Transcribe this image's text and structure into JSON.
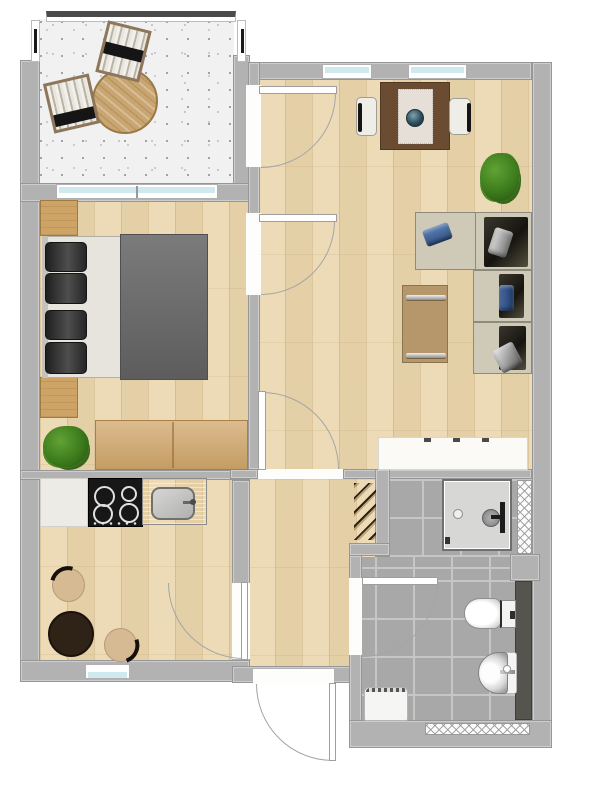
{
  "meta": {
    "kind": "apartment-floor-plan",
    "view": "top-down 2D render"
  },
  "colors": {
    "wall": "#b3b2b2",
    "wall_line": "#969696",
    "wood_floor": "#ecdbb6",
    "balcony_floor": "#f2f1f1",
    "tile": "#a8a8a8",
    "tile_grout": "#c6c6c6",
    "window_glass": "#cfe9ef",
    "railing_dark": "#4b4b4b",
    "door_arc": "#a5a5a5",
    "sofa_beige": "#cfc9b8",
    "sofa_shadow": "#1d1b15",
    "pillow_blue": "#40619c",
    "pillow_gray": "#9b9b99",
    "bed_blanket": "#6c6c6c",
    "bed_sheet": "#e7e4de",
    "bed_pillow": "#303030",
    "wood_furniture": "#cda466",
    "dining_table_brown": "#6a4c33",
    "kitchen_table_brown": "#2f2318",
    "chair_beige": "#d5ba93",
    "plant_green": "#3f7a1e",
    "white_furniture": "#fbfaf6",
    "steel": "#b9b8b6",
    "cooktop_black": "#171717",
    "dark_counter": "#56544e",
    "shower_tray": "#d7d7d6"
  },
  "rooms": [
    {
      "id": "balcony",
      "furniture": [
        "round-wood-table",
        "lounge-chair",
        "lounge-chair"
      ]
    },
    {
      "id": "living-room",
      "furniture": [
        "dining-table",
        "table-runner",
        "decor-bowl",
        "dining-chair",
        "dining-chair",
        "potted-plant",
        "corner-sofa",
        "pillow-blue",
        "pillow-gray",
        "pillow-blue",
        "pillow-gray",
        "coffee-table",
        "sideboard"
      ]
    },
    {
      "id": "bedroom",
      "furniture": [
        "double-bed",
        "bed-pillow",
        "bed-pillow",
        "bed-pillow",
        "bed-pillow",
        "blanket",
        "nightstand",
        "nightstand",
        "dresser",
        "potted-plant"
      ]
    },
    {
      "id": "kitchen",
      "furniture": [
        "counter",
        "cooktop-4-burners",
        "sink-unit",
        "round-table",
        "chair",
        "chair"
      ]
    },
    {
      "id": "hallway",
      "furniture": [
        "coat-hooks"
      ]
    },
    {
      "id": "bathroom",
      "furniture": [
        "shower",
        "wall-radiator",
        "wall-radiator",
        "toilet",
        "washbasin",
        "dark-counter",
        "washing-machine"
      ]
    }
  ],
  "openings": {
    "windows": [
      "bedroom-window",
      "living-window-1",
      "living-window-2",
      "kitchen-window"
    ],
    "doors": [
      "balcony-door",
      "bedroom-door",
      "living-hall-door",
      "kitchen-door",
      "bathroom-door",
      "entrance-door"
    ]
  }
}
